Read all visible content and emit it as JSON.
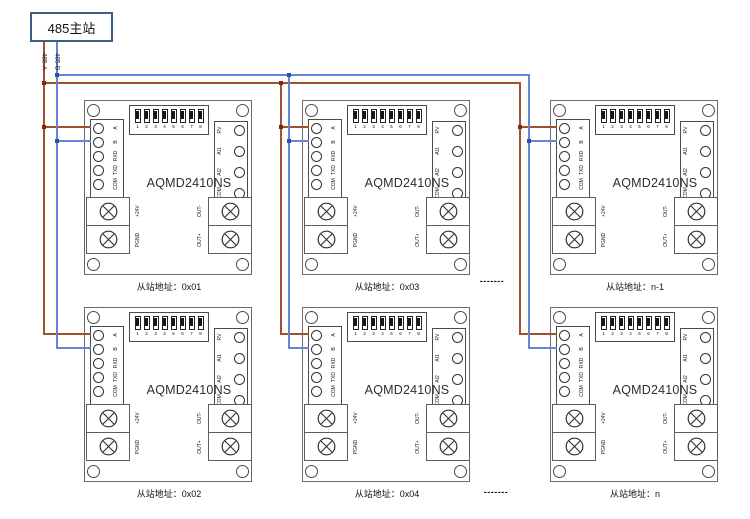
{
  "master": {
    "label": "485主站"
  },
  "bus": {
    "label_a": "485-A",
    "label_b": "485-B"
  },
  "colors": {
    "wire_a": "#a0522d",
    "wire_b": "#6184d8",
    "junction_a": "#7a2c12",
    "junction_b": "#2d4f9e",
    "master_border": "#3c5f86"
  },
  "board": {
    "title": "AQMD2410NS",
    "dip_numbers": [
      "1",
      "2",
      "3",
      "4",
      "5",
      "6",
      "7",
      "8"
    ],
    "left_pins": [
      "A",
      "B",
      "RXD",
      "TXD",
      "COM"
    ],
    "right_pins": [
      "RV",
      "AI1",
      "AI2",
      "COM"
    ],
    "power_pins": [
      "+24V",
      "PGND"
    ],
    "output_pins": [
      "OUT-",
      "OUT+"
    ]
  },
  "boards": [
    {
      "address_label": "从站地址：0x01"
    },
    {
      "address_label": "从站地址：0x03"
    },
    {
      "address_label": "从站地址：n-1"
    },
    {
      "address_label": "从站地址：0x02"
    },
    {
      "address_label": "从站地址：0x04"
    },
    {
      "address_label": "从站地址：n"
    }
  ],
  "separator": "-------"
}
